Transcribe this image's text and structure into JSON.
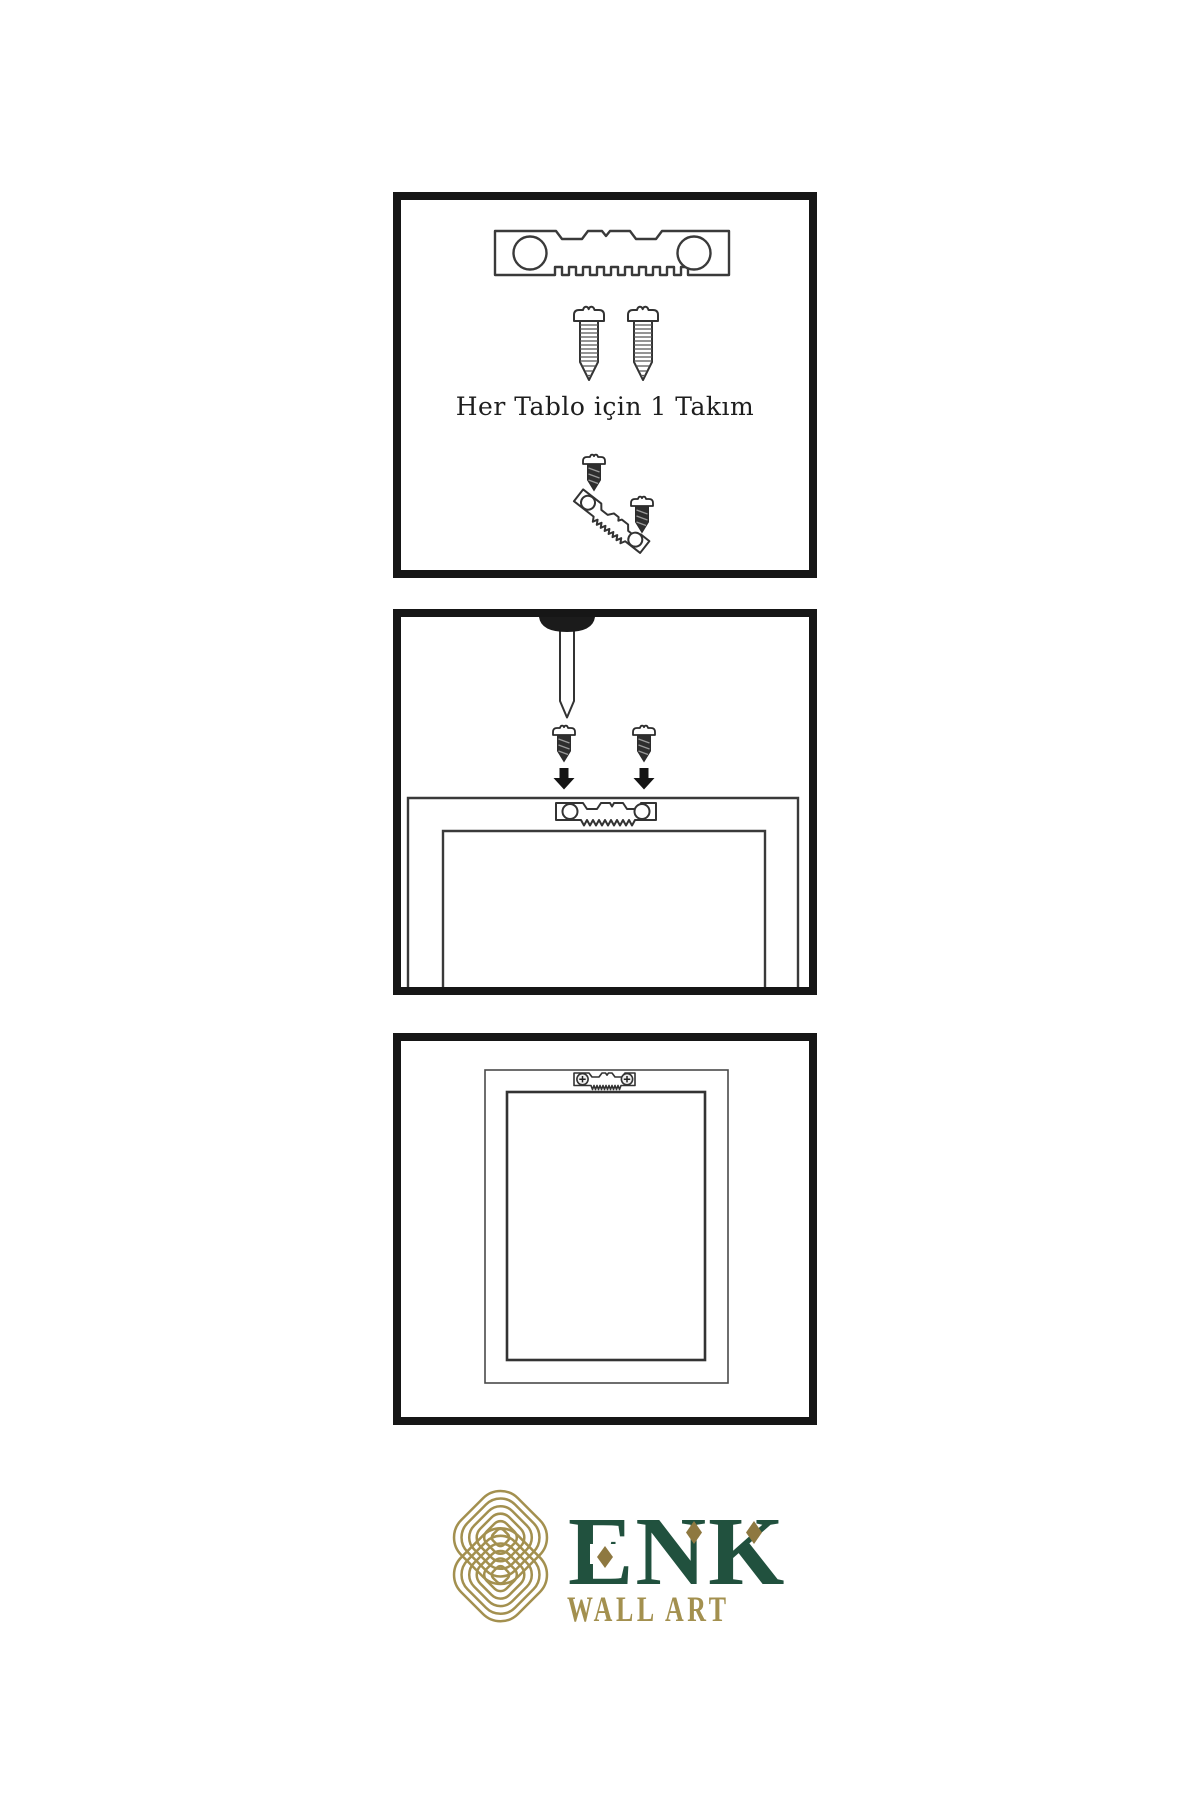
{
  "page": {
    "background": "#ffffff"
  },
  "panels": [
    {
      "name": "hardware-kit",
      "caption": "Her Tablo için 1 Takım",
      "icons": [
        "sawtooth-hanger-icon",
        "screw-icon",
        "screw-icon",
        "small-screw-icon",
        "tilted-sawtooth-hanger-icon",
        "small-screw-icon"
      ]
    },
    {
      "name": "wall-mounting",
      "icons": [
        "nail-icon",
        "small-screw-icon",
        "small-screw-icon",
        "arrow-down-icon",
        "arrow-down-icon",
        "sawtooth-hanger-icon",
        "frame-back-icon"
      ]
    },
    {
      "name": "hung-frame",
      "icons": [
        "mounted-sawtooth-hanger-icon",
        "frame-front-icon"
      ]
    }
  ],
  "logo": {
    "brand": "ENK",
    "subtitle": "WALL ART",
    "icon": "knot-logo-icon",
    "colors": {
      "green": "#21513e",
      "gold": "#a3904f",
      "diamond_gold": "#8e7840"
    }
  },
  "colors": {
    "panel_border": "#161616",
    "line_art": "#333333"
  }
}
